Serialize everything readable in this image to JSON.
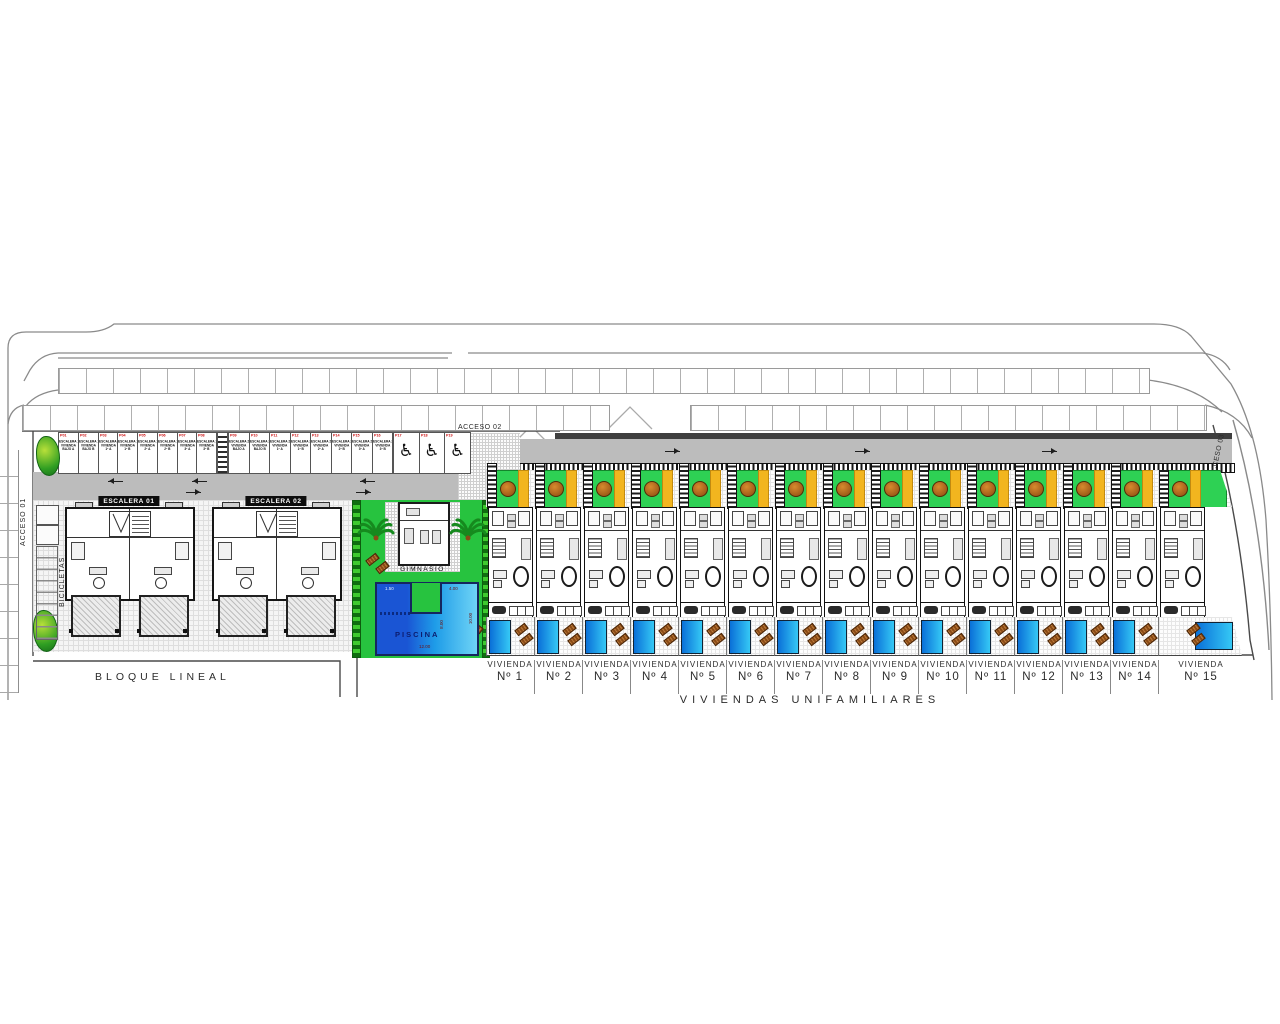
{
  "accesses": {
    "acceso01": "ACCESO 01",
    "acceso02": "ACCESO 02",
    "acceso03": "ACCESO 03"
  },
  "sections": {
    "bloque_lineal": "BLOQUE LINEAL",
    "viviendas_unifamiliares": "VIVIENDAS UNIFAMILIARES",
    "bicicletas": "BICICLETAS"
  },
  "blocks": [
    {
      "label": "ESCALERA 01"
    },
    {
      "label": "ESCALERA 02"
    }
  ],
  "amenities": {
    "gym_label": "GIMNASIO",
    "pool_label": "PISCINA",
    "pool_dims": {
      "top_left": "1.50",
      "top_right": "4.00",
      "right": "10.00",
      "mid": "8.00",
      "bottom": "12.00"
    }
  },
  "parking": {
    "group1": [
      {
        "code": "P01",
        "lines": [
          "ESCALERA 1",
          "VIVIENDA",
          "BAJO A"
        ]
      },
      {
        "code": "P02",
        "lines": [
          "ESCALERA 1",
          "VIVIENDA",
          "BAJO B"
        ]
      },
      {
        "code": "P03",
        "lines": [
          "ESCALERA 1",
          "VIVIENDA",
          "1º A"
        ]
      },
      {
        "code": "P04",
        "lines": [
          "ESCALERA 1",
          "VIVIENDA",
          "1º B"
        ]
      },
      {
        "code": "P05",
        "lines": [
          "ESCALERA 1",
          "VIVIENDA",
          "2º A"
        ]
      },
      {
        "code": "P06",
        "lines": [
          "ESCALERA 1",
          "VIVIENDA",
          "2º B"
        ]
      },
      {
        "code": "P07",
        "lines": [
          "ESCALERA 1",
          "VIVIENDA",
          "3º A"
        ]
      },
      {
        "code": "P08",
        "lines": [
          "ESCALERA 1",
          "VIVIENDA",
          "3º B"
        ]
      }
    ],
    "group2": [
      {
        "code": "P09",
        "lines": [
          "ESCALERA 2",
          "VIVIENDA",
          "BAJO A"
        ]
      },
      {
        "code": "P10",
        "lines": [
          "ESCALERA 2",
          "VIVIENDA",
          "BAJO B"
        ]
      },
      {
        "code": "P11",
        "lines": [
          "ESCALERA 2",
          "VIVIENDA",
          "1º A"
        ]
      },
      {
        "code": "P12",
        "lines": [
          "ESCALERA 2",
          "VIVIENDA",
          "1º B"
        ]
      },
      {
        "code": "P13",
        "lines": [
          "ESCALERA 2",
          "VIVIENDA",
          "2º A"
        ]
      },
      {
        "code": "P14",
        "lines": [
          "ESCALERA 2",
          "VIVIENDA",
          "2º B"
        ]
      },
      {
        "code": "P15",
        "lines": [
          "ESCALERA 2",
          "VIVIENDA",
          "3º A"
        ]
      },
      {
        "code": "P16",
        "lines": [
          "ESCALERA 2",
          "VIVIENDA",
          "3º B"
        ]
      }
    ],
    "handicap": [
      {
        "code": "P17",
        "icon": "wheelchair"
      },
      {
        "code": "P18",
        "icon": "wheelchair"
      },
      {
        "code": "P19",
        "icon": "wheelchair"
      }
    ]
  },
  "viviendas": {
    "word": "VIVIENDA",
    "numbers": [
      "Nº 1",
      "Nº 2",
      "Nº 3",
      "Nº 4",
      "Nº 5",
      "Nº 6",
      "Nº 7",
      "Nº 8",
      "Nº 9",
      "Nº 10",
      "Nº 11",
      "Nº 12",
      "Nº 13",
      "Nº 14",
      "Nº 15"
    ]
  },
  "colors": {
    "garden_green": "#2ed154",
    "amenity_green": "#27c33f",
    "pool_blue_dark": "#1a55d4",
    "pool_blue_light": "#6fd4f6",
    "strip_yellow": "#f2b51f",
    "parking_code_red": "#cc1111",
    "asphalt_gray": "#bcbcbc"
  }
}
